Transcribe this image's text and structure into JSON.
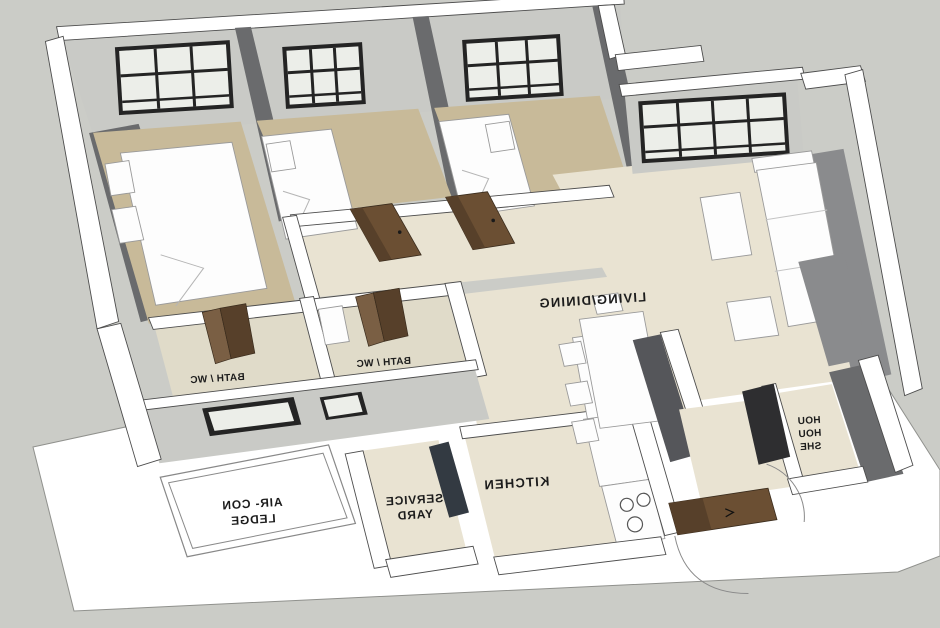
{
  "palette": {
    "background": "#cbccc7",
    "slab": "#ffffff",
    "wall_top": "#ffffff",
    "wall_light": "#c9cac6",
    "wall_medium": "#8a8b8d",
    "wall_dark": "#6a6b6d",
    "wall_darker": "#55565a",
    "floor_bedroom": "#c8ba99",
    "floor_living": "#e9e3d2",
    "floor_bath": "#e0dbc9",
    "window_frame": "#242424",
    "window_pane": "#eceee9",
    "door_brown": "#6b4f33",
    "door_brown_dark": "#57402a",
    "door_brown_light": "#7a5f44",
    "door_shelter": "#2e2e30",
    "glass_dark": "#333a42",
    "furniture": "#fdfdfd",
    "label_text": "#1c1c1c"
  },
  "labels": {
    "living_dining": "LIVING/DINING",
    "kitchen": "KITCHEN",
    "bath_wc_1": "BATH / WC",
    "bath_wc_2": "BATH / WC",
    "service_yard_line1": "SERVICE",
    "service_yard_line2": "YARD",
    "aircon_line1": "AIR- CON",
    "aircon_line2": "LEDGE",
    "shelter_line1": "HOU",
    "shelter_line2": "HOU",
    "shelter_line3": "SHE"
  }
}
